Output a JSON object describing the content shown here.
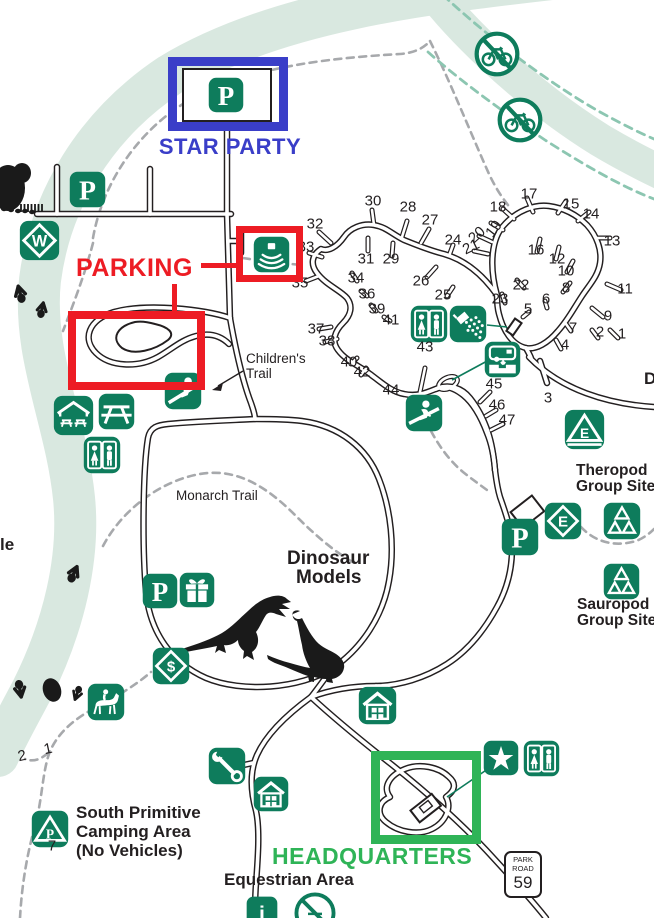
{
  "colors": {
    "icon_green": "#0e7c5c",
    "annotation_red": "#ed1c24",
    "annotation_blue": "#3a3ec8",
    "annotation_green": "#2fb457",
    "river": "#d9e8e0",
    "trail_gray": "#a7a9ac",
    "trail_teal": "#8cc6b1",
    "road_black": "#231f20"
  },
  "annotations": {
    "star_party": {
      "label": "STAR PARTY"
    },
    "parking": {
      "label": "PARKING"
    },
    "headquarters": {
      "label": "HEADQUARTERS"
    }
  },
  "park_road_sign": {
    "line1": "PARK",
    "line2": "ROAD",
    "number": "59"
  },
  "labels": [
    {
      "name": "childrens-trail-label-1",
      "text": "Children's",
      "x": 246,
      "y": 352,
      "kind": "plain"
    },
    {
      "name": "childrens-trail-label-2",
      "text": "Trail",
      "x": 246,
      "y": 367,
      "kind": "plain"
    },
    {
      "name": "monarch-trail-label",
      "text": "Monarch Trail",
      "x": 176,
      "y": 489,
      "kind": "plain"
    },
    {
      "name": "dinosaur-models-label-1",
      "text": "Dinosaur",
      "x": 287,
      "y": 549,
      "kind": "bold19"
    },
    {
      "name": "dinosaur-models-label-2",
      "text": "Models",
      "x": 296,
      "y": 568,
      "kind": "bold19"
    },
    {
      "name": "theropod-group-site-label-1",
      "text": "Theropod",
      "x": 576,
      "y": 463,
      "kind": "bold15"
    },
    {
      "name": "theropod-group-site-label-2",
      "text": "Group Site",
      "x": 576,
      "y": 479,
      "kind": "bold15"
    },
    {
      "name": "sauropod-group-site-label-1",
      "text": "Sauropod",
      "x": 577,
      "y": 597,
      "kind": "bold15"
    },
    {
      "name": "sauropod-group-site-label-2",
      "text": "Group Site",
      "x": 577,
      "y": 613,
      "kind": "bold15"
    },
    {
      "name": "south-primitive-label-1",
      "text": "South Primitive",
      "x": 76,
      "y": 804,
      "kind": "bold17"
    },
    {
      "name": "south-primitive-label-2",
      "text": "Camping Area",
      "x": 76,
      "y": 823,
      "kind": "bold17"
    },
    {
      "name": "south-primitive-label-3",
      "text": "(No Vehicles)",
      "x": 76,
      "y": 842,
      "kind": "bold17"
    },
    {
      "name": "equestrian-area-label",
      "text": "Equestrian Area",
      "x": 224,
      "y": 871,
      "kind": "bold17"
    },
    {
      "name": "cutoff-label-left",
      "text": "le",
      "x": 0,
      "y": 536,
      "kind": "bold17"
    },
    {
      "name": "cutoff-label-right",
      "text": "D",
      "x": 644,
      "y": 370,
      "kind": "bold17"
    }
  ],
  "campsites": [
    {
      "n": "1",
      "x": 622,
      "y": 334
    },
    {
      "n": "2",
      "x": 600,
      "y": 332
    },
    {
      "n": "3",
      "x": 548,
      "y": 398
    },
    {
      "n": "4",
      "x": 565,
      "y": 345
    },
    {
      "n": "5",
      "x": 528,
      "y": 309
    },
    {
      "n": "6",
      "x": 546,
      "y": 299
    },
    {
      "n": "7",
      "x": 573,
      "y": 328
    },
    {
      "n": "8",
      "x": 566,
      "y": 288
    },
    {
      "n": "9",
      "x": 608,
      "y": 316
    },
    {
      "n": "10",
      "x": 566,
      "y": 271
    },
    {
      "n": "11",
      "x": 625,
      "y": 289
    },
    {
      "n": "12",
      "x": 557,
      "y": 259
    },
    {
      "n": "13",
      "x": 612,
      "y": 241
    },
    {
      "n": "14",
      "x": 591,
      "y": 214
    },
    {
      "n": "15",
      "x": 571,
      "y": 204
    },
    {
      "n": "16",
      "x": 536,
      "y": 250
    },
    {
      "n": "17",
      "x": 529,
      "y": 194
    },
    {
      "n": "18",
      "x": 498,
      "y": 207
    },
    {
      "n": "19",
      "x": 494,
      "y": 229,
      "r": -52
    },
    {
      "n": "20",
      "x": 477,
      "y": 235,
      "r": -42
    },
    {
      "n": "21",
      "x": 471,
      "y": 247,
      "r": -26
    },
    {
      "n": "22",
      "x": 521,
      "y": 285
    },
    {
      "n": "23",
      "x": 500,
      "y": 299
    },
    {
      "n": "24",
      "x": 453,
      "y": 240
    },
    {
      "n": "25",
      "x": 443,
      "y": 295
    },
    {
      "n": "26",
      "x": 421,
      "y": 281
    },
    {
      "n": "27",
      "x": 430,
      "y": 220
    },
    {
      "n": "28",
      "x": 408,
      "y": 207
    },
    {
      "n": "29",
      "x": 391,
      "y": 259
    },
    {
      "n": "30",
      "x": 373,
      "y": 201
    },
    {
      "n": "31",
      "x": 366,
      "y": 259
    },
    {
      "n": "32",
      "x": 315,
      "y": 224
    },
    {
      "n": "33",
      "x": 306,
      "y": 247
    },
    {
      "n": "34",
      "x": 356,
      "y": 278
    },
    {
      "n": "35",
      "x": 300,
      "y": 283
    },
    {
      "n": "36",
      "x": 367,
      "y": 294
    },
    {
      "n": "37",
      "x": 316,
      "y": 329
    },
    {
      "n": "38",
      "x": 327,
      "y": 341
    },
    {
      "n": "39",
      "x": 377,
      "y": 309
    },
    {
      "n": "40",
      "x": 349,
      "y": 362
    },
    {
      "n": "41",
      "x": 391,
      "y": 320
    },
    {
      "n": "42",
      "x": 362,
      "y": 372
    },
    {
      "n": "43",
      "x": 425,
      "y": 347
    },
    {
      "n": "44",
      "x": 391,
      "y": 390
    },
    {
      "n": "45",
      "x": 494,
      "y": 384
    },
    {
      "n": "46",
      "x": 497,
      "y": 405
    },
    {
      "n": "47",
      "x": 507,
      "y": 420
    }
  ],
  "trail_markers": [
    {
      "n": "2",
      "x": 22,
      "y": 756,
      "r": -12
    },
    {
      "n": "1",
      "x": 48,
      "y": 749,
      "r": -12
    },
    {
      "n": "7",
      "x": 52,
      "y": 846
    }
  ],
  "icons": [
    {
      "name": "no-bikes-icon",
      "glyph": "nobike",
      "x": 497,
      "y": 54,
      "s": 46
    },
    {
      "name": "no-bikes-icon",
      "glyph": "nobike",
      "x": 520,
      "y": 120,
      "s": 46
    },
    {
      "name": "parking-icon",
      "glyph": "p",
      "letter": "P",
      "x": 87,
      "y": 189,
      "s": 37
    },
    {
      "name": "parking-icon",
      "glyph": "p",
      "letter": "P",
      "x": 226,
      "y": 95,
      "s": 36
    },
    {
      "name": "water-crossing-icon",
      "glyph": "diamond",
      "letter": "W",
      "x": 39,
      "y": 240,
      "s": 41
    },
    {
      "name": "amphitheater-icon",
      "glyph": "amp",
      "x": 271,
      "y": 254,
      "s": 37
    },
    {
      "name": "restroom-icon",
      "glyph": "wc",
      "x": 429,
      "y": 324,
      "s": 38
    },
    {
      "name": "shower-icon",
      "glyph": "shower",
      "x": 468,
      "y": 324,
      "s": 38
    },
    {
      "name": "dump-station-icon",
      "glyph": "dump",
      "x": 502,
      "y": 359,
      "s": 37
    },
    {
      "name": "track-viewing-icon",
      "glyph": "kneel",
      "x": 424,
      "y": 413,
      "s": 38
    },
    {
      "name": "playground-icon",
      "glyph": "play",
      "x": 183,
      "y": 391,
      "s": 38
    },
    {
      "name": "group-shelter-icon",
      "glyph": "shelter",
      "x": 73,
      "y": 415,
      "s": 41
    },
    {
      "name": "picnic-area-icon",
      "glyph": "picnic",
      "x": 116,
      "y": 411,
      "s": 37
    },
    {
      "name": "restroom-icon",
      "glyph": "wc",
      "x": 102,
      "y": 455,
      "s": 38
    },
    {
      "name": "parking-icon",
      "glyph": "p",
      "letter": "P",
      "x": 160,
      "y": 591,
      "s": 36
    },
    {
      "name": "gift-shop-icon",
      "glyph": "gift",
      "x": 197,
      "y": 590,
      "s": 36
    },
    {
      "name": "fee-station-icon",
      "glyph": "diamond",
      "letter": "$",
      "x": 171,
      "y": 666,
      "s": 38
    },
    {
      "name": "equestrian-icon",
      "glyph": "horse",
      "x": 106,
      "y": 702,
      "s": 38
    },
    {
      "name": "primitive-camping-icon",
      "glyph": "tentp",
      "letter": "P",
      "x": 50,
      "y": 829,
      "s": 38
    },
    {
      "name": "residence-icon",
      "glyph": "house",
      "x": 377,
      "y": 705,
      "s": 39
    },
    {
      "name": "maintenance-icon",
      "glyph": "wrench",
      "x": 227,
      "y": 766,
      "s": 38
    },
    {
      "name": "residence-icon",
      "glyph": "house",
      "x": 271,
      "y": 794,
      "s": 36
    },
    {
      "name": "headquarters-star-icon",
      "glyph": "star",
      "x": 501,
      "y": 758,
      "s": 36
    },
    {
      "name": "restroom-icon",
      "glyph": "wc",
      "x": 541,
      "y": 758,
      "s": 37
    },
    {
      "name": "parking-icon",
      "glyph": "p",
      "letter": "P",
      "x": 520,
      "y": 537,
      "s": 38
    },
    {
      "name": "exit-marker-icon",
      "glyph": "diamond",
      "letter": "E",
      "x": 563,
      "y": 521,
      "s": 38
    },
    {
      "name": "group-camp-icon",
      "glyph": "tents",
      "x": 622,
      "y": 521,
      "s": 38
    },
    {
      "name": "group-camp-icon",
      "glyph": "tents",
      "x": 621,
      "y": 581,
      "s": 37
    },
    {
      "name": "walk-in-camp-icon",
      "glyph": "tente",
      "letter": "E",
      "x": 584,
      "y": 429,
      "s": 41
    },
    {
      "name": "information-icon",
      "glyph": "info",
      "letter": "i",
      "x": 262,
      "y": 912,
      "s": 32
    },
    {
      "name": "prohibited-icon",
      "glyph": "noslash",
      "x": 315,
      "y": 913,
      "s": 42
    }
  ]
}
